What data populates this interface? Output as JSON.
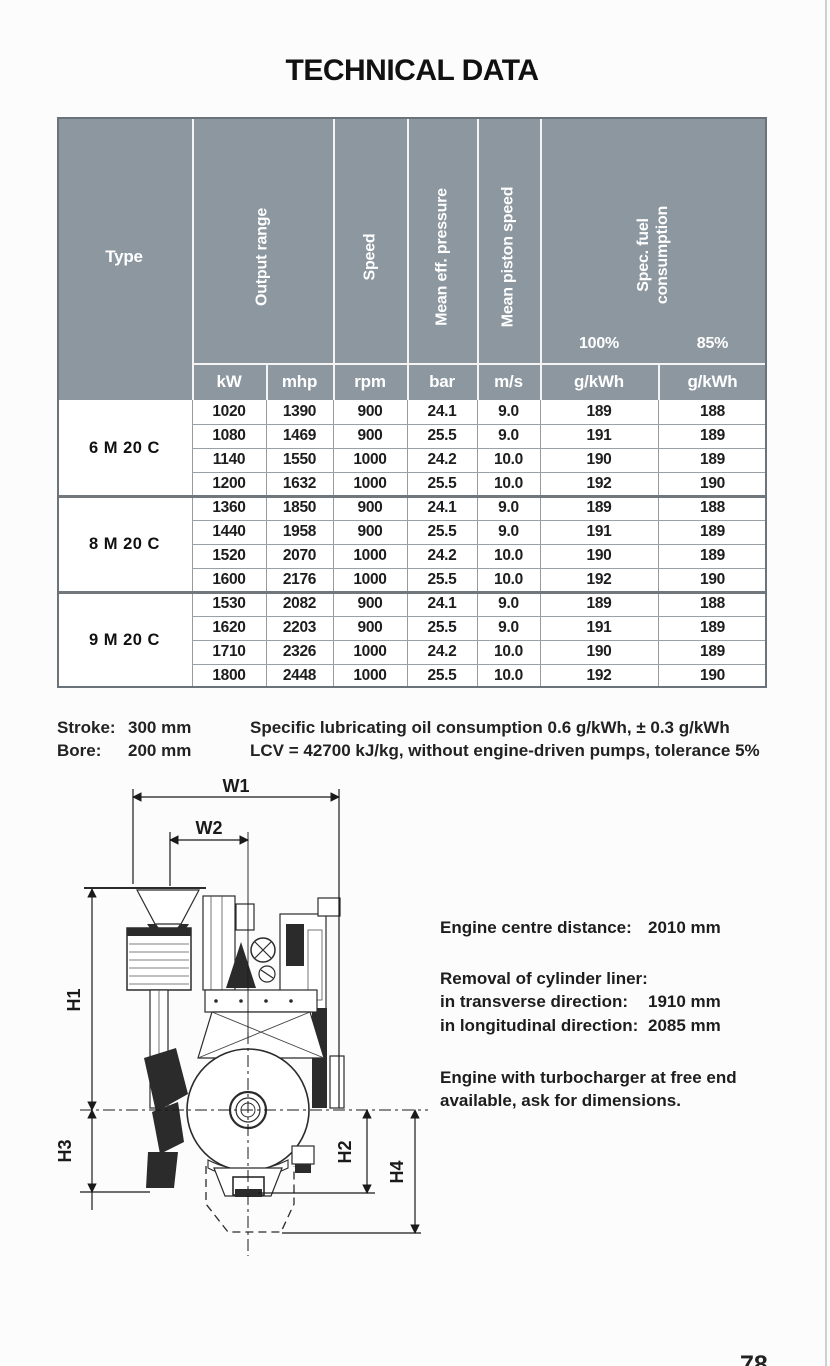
{
  "page": {
    "title": "TECHNICAL DATA",
    "page_number": "78"
  },
  "table": {
    "headers": {
      "type": "Type",
      "output_range": "Output range",
      "speed": "Speed",
      "mean_eff_pressure": "Mean eff. pressure",
      "mean_piston_speed": "Mean piston speed",
      "spec_fuel_consumption": "Spec. fuel\nconsumption"
    },
    "load_labels": [
      "100%",
      "85%"
    ],
    "units": [
      "kW",
      "mhp",
      "rpm",
      "bar",
      "m/s",
      "g/kWh",
      "g/kWh"
    ],
    "groups": [
      {
        "type": "6 M 20 C",
        "rows": [
          [
            "1020",
            "1390",
            "900",
            "24.1",
            "9.0",
            "189",
            "188"
          ],
          [
            "1080",
            "1469",
            "900",
            "25.5",
            "9.0",
            "191",
            "189"
          ],
          [
            "1140",
            "1550",
            "1000",
            "24.2",
            "10.0",
            "190",
            "189"
          ],
          [
            "1200",
            "1632",
            "1000",
            "25.5",
            "10.0",
            "192",
            "190"
          ]
        ]
      },
      {
        "type": "8 M 20 C",
        "rows": [
          [
            "1360",
            "1850",
            "900",
            "24.1",
            "9.0",
            "189",
            "188"
          ],
          [
            "1440",
            "1958",
            "900",
            "25.5",
            "9.0",
            "191",
            "189"
          ],
          [
            "1520",
            "2070",
            "1000",
            "24.2",
            "10.0",
            "190",
            "189"
          ],
          [
            "1600",
            "2176",
            "1000",
            "25.5",
            "10.0",
            "192",
            "190"
          ]
        ]
      },
      {
        "type": "9 M 20 C",
        "rows": [
          [
            "1530",
            "2082",
            "900",
            "24.1",
            "9.0",
            "189",
            "188"
          ],
          [
            "1620",
            "2203",
            "900",
            "25.5",
            "9.0",
            "191",
            "189"
          ],
          [
            "1710",
            "2326",
            "1000",
            "24.2",
            "10.0",
            "190",
            "189"
          ],
          [
            "1800",
            "2448",
            "1000",
            "25.5",
            "10.0",
            "192",
            "190"
          ]
        ]
      }
    ]
  },
  "notes": {
    "stroke_label": "Stroke:",
    "stroke_value": "300 mm",
    "bore_label": "Bore:",
    "bore_value": "200 mm",
    "line1": "Specific lubricating oil consumption 0.6 g/kWh, ± 0.3 g/kWh",
    "line2": "LCV = 42700 kJ/kg, without engine-driven pumps, tolerance 5%"
  },
  "drawing": {
    "w1": "W1",
    "w2": "W2",
    "h1": "H1",
    "h2": "H2",
    "h3": "H3",
    "h4": "H4"
  },
  "side_info": {
    "centre_label": "Engine centre distance:",
    "centre_value": "2010 mm",
    "removal_title": "Removal of cylinder liner:",
    "transverse_label": "in transverse direction:",
    "transverse_value": "1910 mm",
    "longitudinal_label": "in longitudinal direction:",
    "longitudinal_value": "2085 mm",
    "turbo_note_line1": "Engine with turbocharger at free end",
    "turbo_note_line2": "available, ask for dimensions."
  },
  "colors": {
    "header_bg": "#8c97a0",
    "accent_border": "#6a737a"
  }
}
